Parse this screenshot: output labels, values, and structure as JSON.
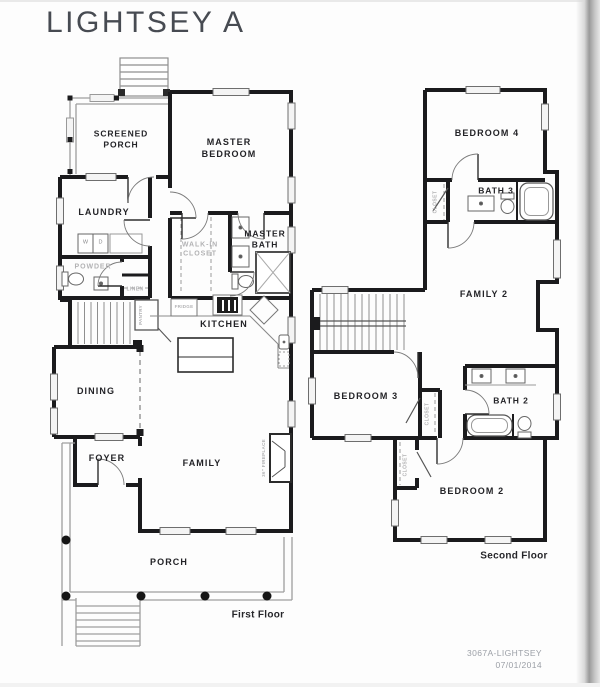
{
  "title": "LIGHTSEY A",
  "footer": {
    "plan_id": "3067A-LIGHTSEY",
    "date": "07/01/2014"
  },
  "colors": {
    "wall": "#1b1b1d",
    "ink": "#232327",
    "muted_label": "#b2b2b4",
    "footer_text": "#9b9fa6",
    "paper": "#fdfdfd"
  },
  "first_floor": {
    "caption": "First Floor",
    "labels": {
      "screened_porch": "SCREENED\nPORCH",
      "master_bedroom": "MASTER\nBEDROOM",
      "laundry": "LAUNDRY",
      "washer": "W",
      "dryer": "D",
      "powder": "POWDER",
      "linen": "LINEN",
      "walk_in_closet": "WALK-IN\nCLOSET",
      "master_bath": "MASTER\nBATH",
      "fridge": "FRIDGE",
      "pantry": "PANTRY",
      "kitchen": "KITCHEN",
      "dining": "DINING",
      "foyer": "FOYER",
      "family": "FAMILY",
      "fireplace": "36\" FIREPLACE",
      "porch": "PORCH"
    }
  },
  "second_floor": {
    "caption": "Second Floor",
    "labels": {
      "bedroom_4": "BEDROOM 4",
      "closet_b4": "CLOSET",
      "bath_3": "BATH 3",
      "family_2": "FAMILY 2",
      "bedroom_3": "BEDROOM 3",
      "closet_b3": "CLOSET",
      "bath_2": "BATH 2",
      "closet_b2": "CLOSET",
      "bedroom_2": "BEDROOM 2"
    }
  }
}
